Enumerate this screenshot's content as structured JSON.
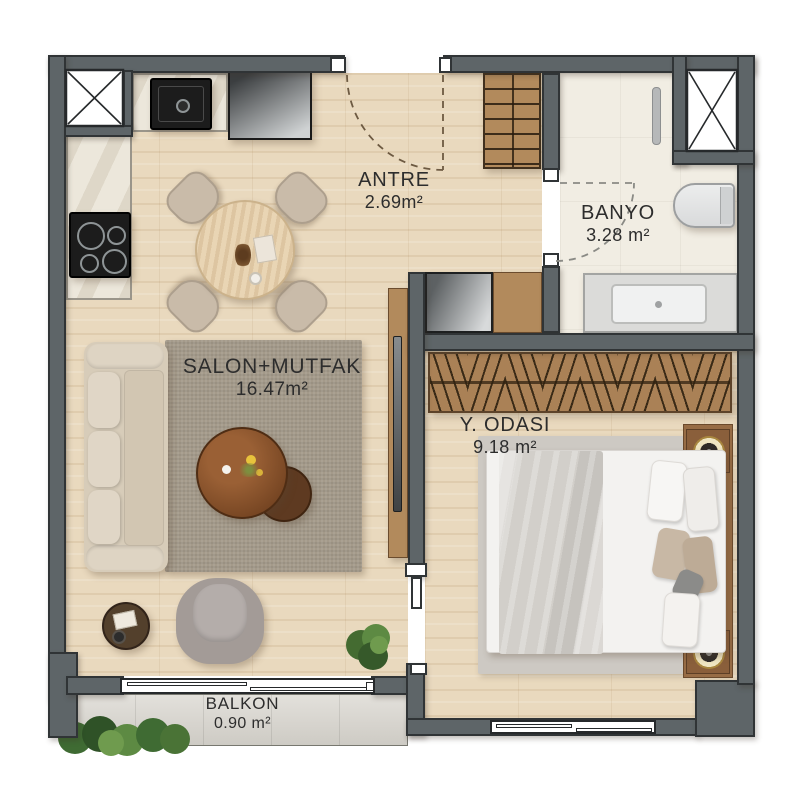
{
  "title": "apartment-floor-plan",
  "rooms": {
    "antre": {
      "label": "ANTRE",
      "area": "2.69m²"
    },
    "banyo": {
      "label": "BANYO",
      "area": "3.28 m²"
    },
    "salon": {
      "label": "SALON+MUTFAK",
      "area": "16.47m²"
    },
    "yodasi": {
      "label": "Y. ODASI",
      "area": "9.18 m²"
    },
    "balkon": {
      "label": "BALKON",
      "area": "0.90 m²"
    }
  },
  "fixtures": {
    "kitchen": [
      "kitchen-sink",
      "refrigerator",
      "cooktop",
      "counter",
      "dining-table",
      "dining-chairs-x4"
    ],
    "antre": [
      "entry-door-swing",
      "shoe-cabinet",
      "appliance-cabinet",
      "wood-counter"
    ],
    "banyo": [
      "towel-radiator",
      "toilet",
      "vanity-sink",
      "door-swing",
      "ventilation-shaft"
    ],
    "salon": [
      "sofa",
      "area-rug",
      "coffee-table-large",
      "coffee-table-small",
      "side-table",
      "armchair",
      "potted-plant",
      "tv-unit",
      "balcony-sliding-door"
    ],
    "yodasi": [
      "wardrobe-hangers",
      "area-rug",
      "double-bed",
      "pillows",
      "headboard",
      "nightstand-lamp-x2",
      "window",
      "pocket-door"
    ],
    "balkon": [
      "planter-box"
    ],
    "shared": [
      "ventilation-shaft-x2"
    ]
  },
  "colors": {
    "wall": "#5e6568",
    "wall_outline": "#303436",
    "wood_floor": "#e9d9be",
    "tile_floor": "#f1ede3",
    "balcony_floor": "#d9d6cf",
    "salon_rug": "#a49a8a",
    "bedroom_rug": "#cdc9c3",
    "furniture_wood": "#b28a5c",
    "walnut_table": "#6f401f",
    "label_text": "#2d2d2d"
  }
}
